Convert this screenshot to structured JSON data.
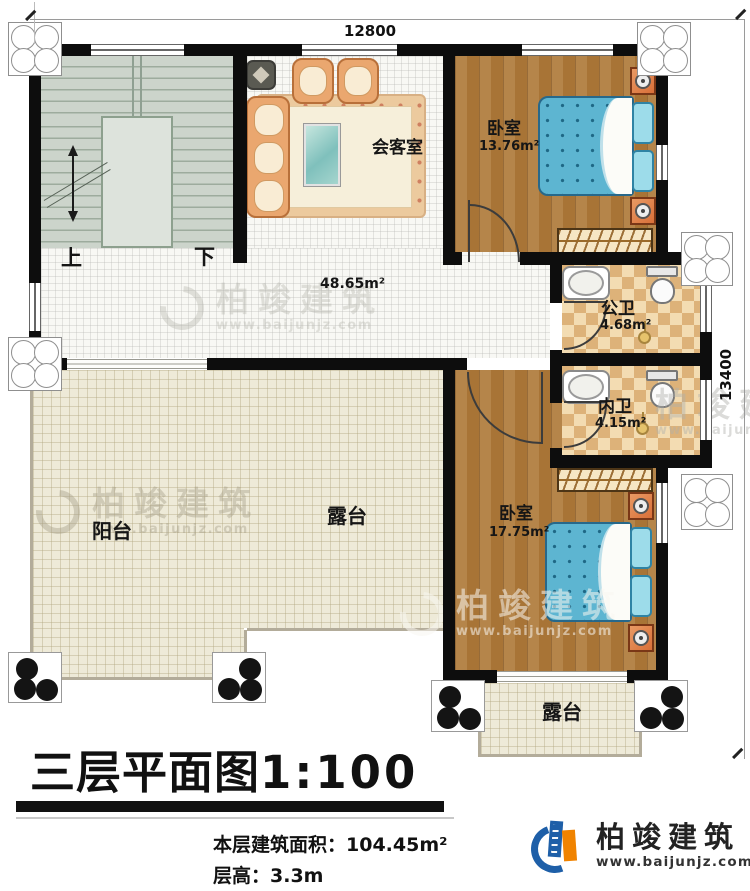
{
  "dimensions": {
    "width_mm": "12800",
    "height_mm": "13400"
  },
  "stairwell": {
    "up": "上",
    "down": "下"
  },
  "rooms": {
    "reception": {
      "name": "会客室"
    },
    "hall": {
      "area": "48.65m²"
    },
    "bedroom_top": {
      "name": "卧室",
      "area": "13.76m²"
    },
    "bedroom_bottom": {
      "name": "卧室",
      "area": "17.75m²"
    },
    "public_bathroom": {
      "name": "公卫",
      "area": "4.68m²"
    },
    "inner_bathroom": {
      "name": "内卫",
      "area": "4.15m²"
    },
    "balcony": {
      "name": "阳台"
    },
    "terrace_left": {
      "name": "露台"
    },
    "terrace_bottom": {
      "name": "露台"
    }
  },
  "footer": {
    "plan_title": "三层平面图",
    "plan_scale": "1:100",
    "floor_area_label": "本层建筑面积：",
    "floor_area_value": "104.45m²",
    "floor_height_label": "层高：",
    "floor_height_value": "3.3m"
  },
  "branding": {
    "company": "柏竣建筑",
    "website": "www.baijunjz.com"
  },
  "watermark": {
    "company": "柏竣建筑",
    "website": "www.baijunjz.com"
  },
  "colors": {
    "wall": "#0d0d0d",
    "wood_floor": "#b08040",
    "bath_tile": "#e9c089",
    "terrace_floor": "#eeead8",
    "stair_floor": "#ccd4cb",
    "bed_blue": "#5db5d1",
    "sofa_peach": "#eaa76f",
    "logo_blue": "#1e5fa8",
    "logo_orange": "#f08300"
  }
}
